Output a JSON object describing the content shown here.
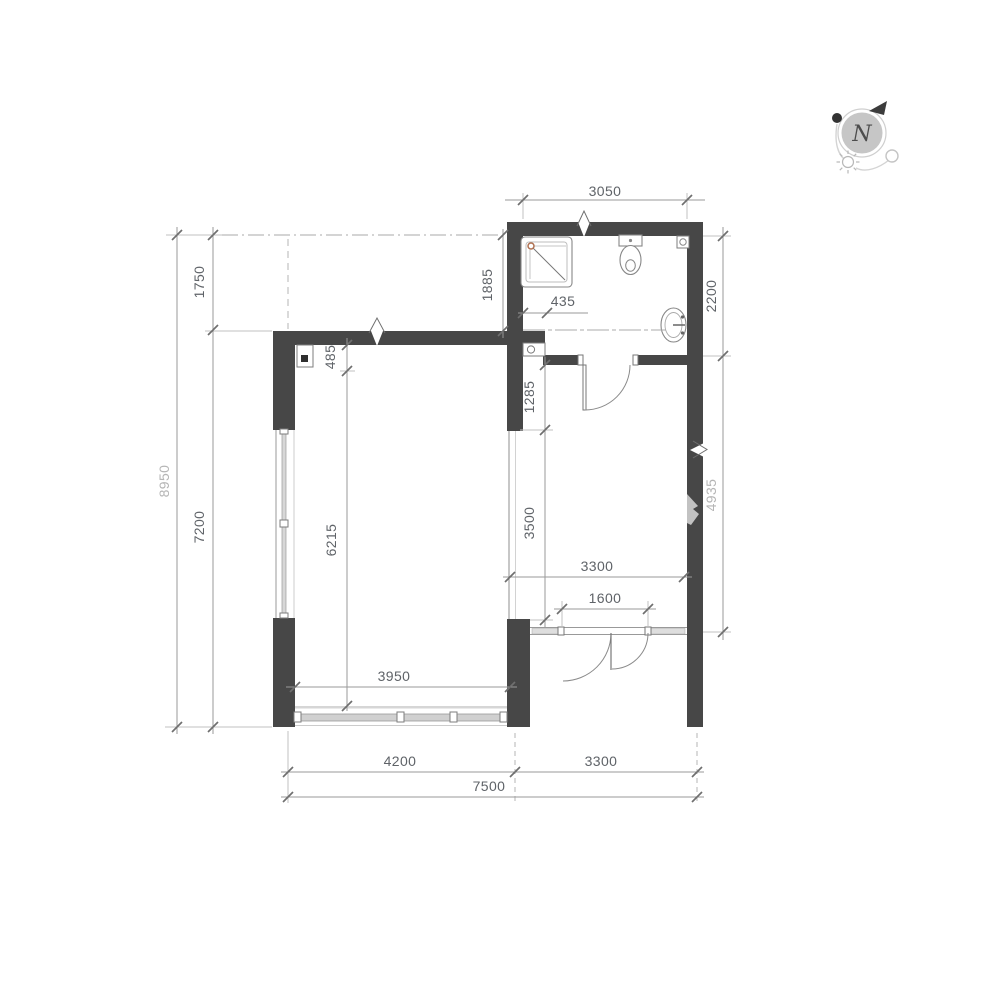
{
  "drawing": {
    "type": "apartment floor plan",
    "colors": {
      "wall": "#474747",
      "dimension_text": "#5f6368",
      "dimension_text_light": "#b5b5b5",
      "line": "#9a9a9a",
      "shower_marker": "#b07050"
    },
    "compass": {
      "letter": "N"
    },
    "dims": {
      "top_width": "3050",
      "bath_side": "1885",
      "shaft": "435",
      "bath_depth": "2200",
      "left_total": "8950",
      "left_offset": "1750",
      "left_height": "7200",
      "column": "485",
      "living_length": "6215",
      "hall_wall": "1285",
      "opening": "3500",
      "hall_height": "4935",
      "hall_width": "3300",
      "entry_door": "1600",
      "living_window": "3950",
      "bottom_living": "4200",
      "bottom_hall": "3300",
      "bottom_total": "7500"
    }
  }
}
